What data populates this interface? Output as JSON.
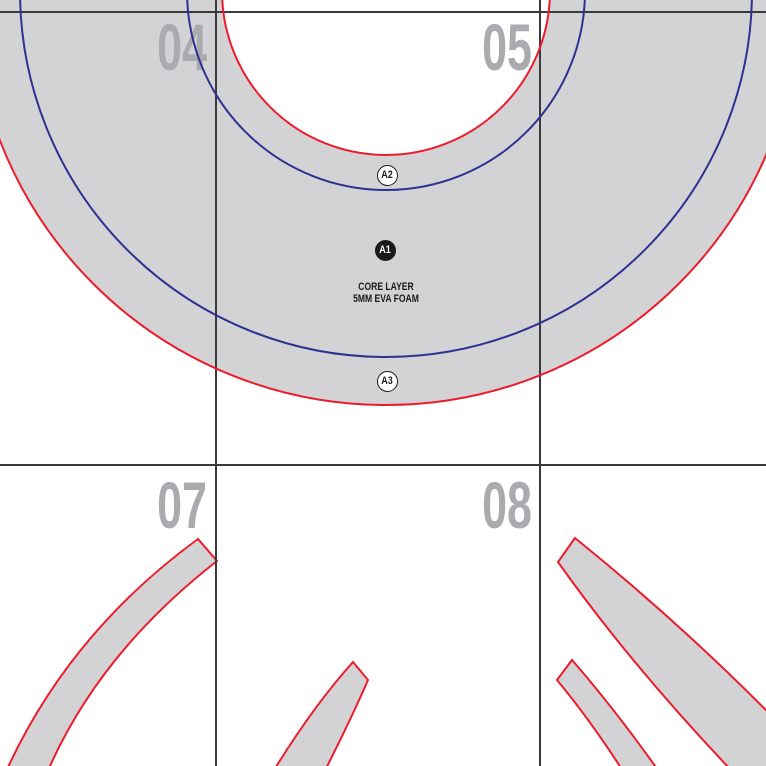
{
  "document": {
    "kind": "tiled-pattern-sheet"
  },
  "pages": [
    {
      "number": "04"
    },
    {
      "number": "05"
    },
    {
      "number": "07"
    },
    {
      "number": "08"
    }
  ],
  "part_labels": [
    {
      "text": "A2"
    },
    {
      "text": "A1"
    },
    {
      "text": "A3"
    }
  ],
  "piece_note": {
    "line1": "CORE LAYER",
    "line2": "5MM EVA FOAM"
  },
  "colors": {
    "cut_line_red": "#EC1C2C",
    "mark_line_blue": "#2E3192",
    "piece_fill_gray": "#D3D3D5",
    "grid_line": "#3A3A3C",
    "page_number_gray": "#A9ABAE",
    "label_black": "#1A1A1A",
    "background": "#FFFFFF"
  }
}
